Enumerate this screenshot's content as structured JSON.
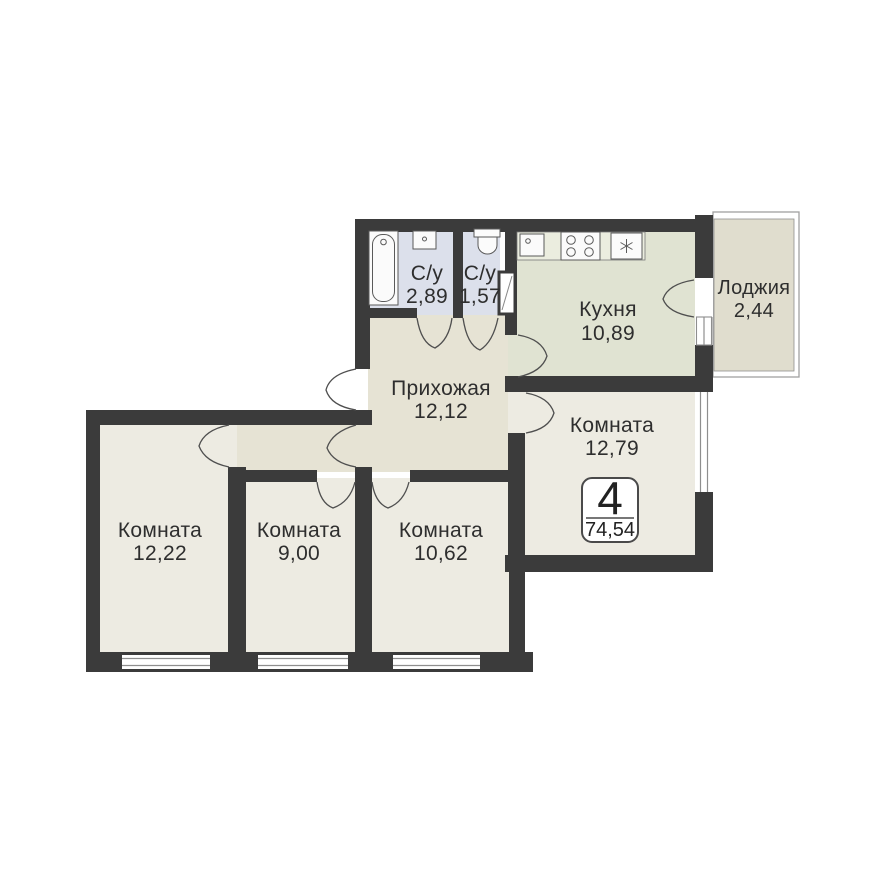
{
  "unit": {
    "rooms_count": "4",
    "total_area": "74,54"
  },
  "rooms": [
    {
      "name": "С/у",
      "area": "2,89"
    },
    {
      "name": "С/у",
      "area": "1,57"
    },
    {
      "name": "Кухня",
      "area": "10,89"
    },
    {
      "name": "Лоджия",
      "area": "2,44"
    },
    {
      "name": "Прихожая",
      "area": "12,12"
    },
    {
      "name": "Комната",
      "area": "12,79"
    },
    {
      "name": "Комната",
      "area": "12,22"
    },
    {
      "name": "Комната",
      "area": "9,00"
    },
    {
      "name": "Комната",
      "area": "10,62"
    }
  ],
  "fixture_icons": [
    "bathtub-icon",
    "washbasin-icon",
    "toilet-icon",
    "kitchen-sink-icon",
    "stove-icon",
    "fridge-icon",
    "vent-shaft-icon"
  ],
  "colors": {
    "wall": "#3b3b3b",
    "room_floor": "#edebe2",
    "hallway_floor": "#e6e3d4",
    "kitchen_floor": "#e0e3d2",
    "bathroom_floor": "#dce0eb",
    "loggia_floor": "#e0ddce",
    "background": "#ffffff",
    "text": "#2e2e2e"
  }
}
